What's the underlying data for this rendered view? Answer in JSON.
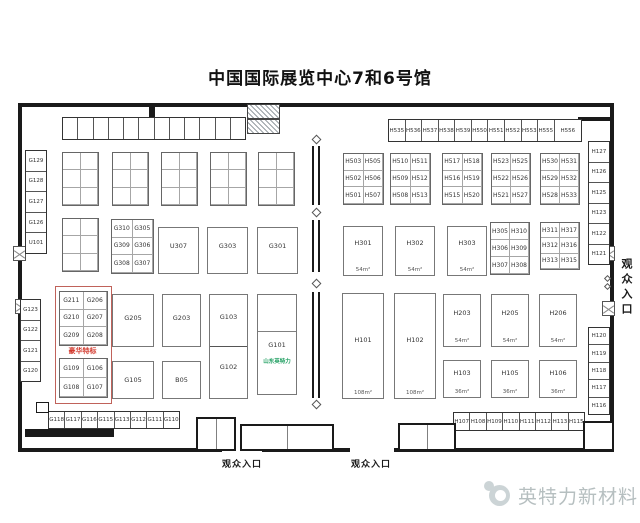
{
  "title": "中国国际展览中心7和6号馆",
  "entrances": {
    "south_left": "观众入口",
    "south_right": "观众入口",
    "east": "观众入口"
  },
  "footer": {
    "brand": "英特力新材料"
  },
  "colors": {
    "deluxe_red": "#d23a2e",
    "company_green": "#1e9e60",
    "wall": "#1a1a1a",
    "watermark_gray": "#b6bfc0"
  },
  "left_hall": {
    "west_column_upper": [
      "G129",
      "G128",
      "G127",
      "G126",
      "U101"
    ],
    "west_column_lower": [
      "G123",
      "G122",
      "G121",
      "G120"
    ],
    "grid_g300": [
      [
        "G310",
        "G305"
      ],
      [
        "G309",
        "G306"
      ],
      [
        "G308",
        "G307"
      ]
    ],
    "row2_blocks": {
      "b1": "U307",
      "b2": "G303",
      "b3": "G301"
    },
    "deluxe": {
      "label": "豪华特标",
      "top_grid": [
        [
          "G211",
          "G206"
        ],
        [
          "G210",
          "G207"
        ],
        [
          "G209",
          "G208"
        ]
      ],
      "bottom_grid": [
        [
          "G109",
          "G106"
        ],
        [
          "G108",
          "G107"
        ]
      ]
    },
    "g205": "G205",
    "g203": "G203",
    "g103": "G103",
    "g102": "G102",
    "g101": "G101",
    "g101_company": "山东英特力",
    "g105": "G105",
    "b05": "B05",
    "south_strip": [
      "G118",
      "G117",
      "G116",
      "G115",
      "G113",
      "G112",
      "G111",
      "G110"
    ]
  },
  "right_hall": {
    "north_strip": [
      "H535",
      "H536",
      "H537",
      "H538",
      "H539",
      "H550",
      "H551",
      "H552",
      "H553",
      "H555",
      "H556"
    ],
    "h500_grid_1": [
      [
        "H503",
        "H505"
      ],
      [
        "H502",
        "H506"
      ],
      [
        "H501",
        "H507"
      ]
    ],
    "h500_grid_2": [
      [
        "H510",
        "H511"
      ],
      [
        "H509",
        "H512"
      ],
      [
        "H508",
        "H513"
      ]
    ],
    "h500_grid_3": [
      [
        "H517",
        "H518"
      ],
      [
        "H516",
        "H519"
      ],
      [
        "H515",
        "H520"
      ]
    ],
    "h500_grid_4": [
      [
        "H523",
        "H525"
      ],
      [
        "H522",
        "H526"
      ],
      [
        "H521",
        "H527"
      ]
    ],
    "h500_grid_5": [
      [
        "H530",
        "H531"
      ],
      [
        "H529",
        "H532"
      ],
      [
        "H528",
        "H533"
      ]
    ],
    "h300_blocks": [
      {
        "id": "H301",
        "area": "54m²"
      },
      {
        "id": "H302",
        "area": "54m²"
      },
      {
        "id": "H303",
        "area": "54m²"
      }
    ],
    "h300_grid_1": [
      [
        "H305",
        "H310"
      ],
      [
        "H306",
        "H309"
      ],
      [
        "H307",
        "H308"
      ]
    ],
    "h300_grid_2": [
      [
        "H311",
        "H317"
      ],
      [
        "H312",
        "H316"
      ],
      [
        "H313",
        "H315"
      ]
    ],
    "h100_tall": [
      {
        "id": "H101",
        "area": "108m²"
      },
      {
        "id": "H102",
        "area": "108m²"
      }
    ],
    "h200_blocks": [
      {
        "id": "H203",
        "area": "54m²"
      },
      {
        "id": "H205",
        "area": "54m²"
      },
      {
        "id": "H206",
        "area": "54m²"
      }
    ],
    "h100_blocks": [
      {
        "id": "H103",
        "area": "36m²"
      },
      {
        "id": "H105",
        "area": "36m²"
      },
      {
        "id": "H106",
        "area": "36m²"
      }
    ],
    "south_strip": [
      "H107",
      "H108",
      "H109",
      "H110",
      "H111",
      "H112",
      "H113",
      "H115"
    ],
    "east_column_upper": [
      "H127",
      "H126",
      "H125",
      "H123",
      "H122",
      "H121"
    ],
    "east_column_lower": [
      "H120",
      "H119",
      "H118",
      "H117",
      "H116"
    ]
  }
}
